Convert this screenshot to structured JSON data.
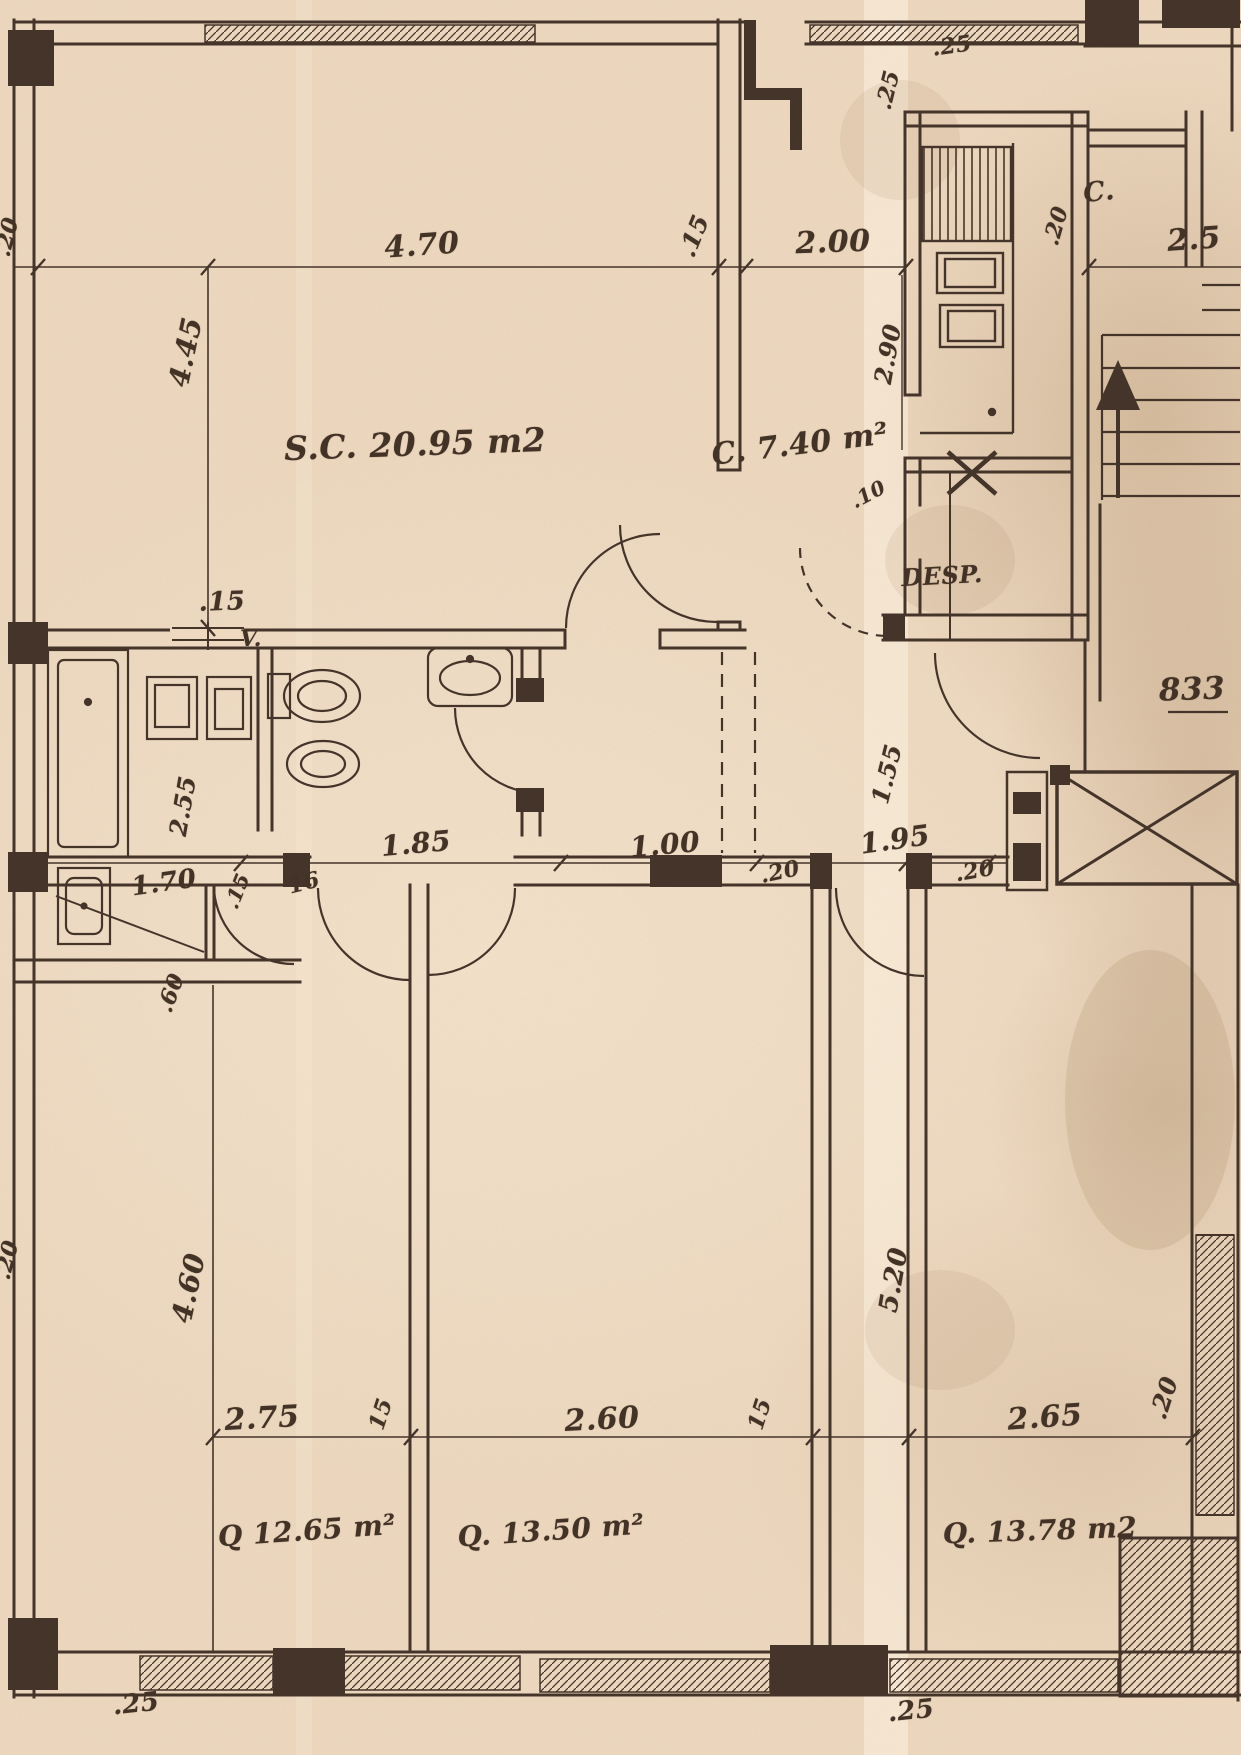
{
  "plan": {
    "kind": "architectural-floor-plan",
    "style": "aged-scanned-blueprint",
    "units": "meters",
    "colors": {
      "paper": "#eed9c0",
      "ink": "#45342a",
      "stain": "#8f6a42",
      "fold_highlight": "#fff6e6"
    },
    "rooms": [
      {
        "name": "living-dining-room",
        "code": "S.C.",
        "area_m2": 20.95
      },
      {
        "name": "kitchen",
        "code": "C.",
        "area_m2": 7.4
      },
      {
        "name": "pantry",
        "code": "DESP."
      },
      {
        "name": "stair-hall",
        "code": "C."
      },
      {
        "name": "bedroom-1",
        "code": "Q",
        "area_m2": 12.65
      },
      {
        "name": "bedroom-2",
        "code": "Q.",
        "area_m2": 13.5
      },
      {
        "name": "bedroom-3",
        "code": "Q.",
        "area_m2": 13.78
      }
    ],
    "sheet_number": "833",
    "labels": [
      {
        "name": "dim-width-living",
        "text": "4.70",
        "x": 422,
        "y": 246,
        "rot": -4,
        "fs": 30
      },
      {
        "name": "dim-height-living",
        "text": "4.45",
        "x": 186,
        "y": 352,
        "rot": -78,
        "fs": 28
      },
      {
        "name": "dim-wall-15-top",
        "text": ".15",
        "x": 694,
        "y": 236,
        "rot": -68,
        "fs": 24
      },
      {
        "name": "dim-width-hall",
        "text": "2.00",
        "x": 833,
        "y": 243,
        "rot": -2,
        "fs": 30
      },
      {
        "name": "dim-25-top",
        "text": ".25",
        "x": 952,
        "y": 46,
        "rot": -8,
        "fs": 22
      },
      {
        "name": "dim-25-top-wall",
        "text": ".25",
        "x": 888,
        "y": 90,
        "rot": -76,
        "fs": 22
      },
      {
        "name": "label-stairhall-c",
        "text": "C.",
        "x": 1099,
        "y": 192,
        "rot": -6,
        "fs": 27
      },
      {
        "name": "dim-20-kitchen-top",
        "text": ".20",
        "x": 1056,
        "y": 226,
        "rot": -74,
        "fs": 22
      },
      {
        "name": "dim-25-right",
        "text": "2.5",
        "x": 1194,
        "y": 240,
        "rot": -4,
        "fs": 30
      },
      {
        "name": "dim-height-kitchen",
        "text": "2.90",
        "x": 888,
        "y": 354,
        "rot": -80,
        "fs": 24
      },
      {
        "name": "room-living-label",
        "text": "S.C. 20.95 m2",
        "x": 415,
        "y": 444,
        "rot": -2,
        "fs": 33
      },
      {
        "name": "room-kitchen-label",
        "text": "C. 7.40 m²",
        "x": 800,
        "y": 445,
        "rot": -7,
        "fs": 30
      },
      {
        "name": "dim-door-10",
        "text": ".10",
        "x": 868,
        "y": 494,
        "rot": -28,
        "fs": 20
      },
      {
        "name": "room-pantry-label",
        "text": "DESP.",
        "x": 942,
        "y": 576,
        "rot": -3,
        "fs": 24
      },
      {
        "name": "dim-wall-15-bath",
        "text": ".15",
        "x": 222,
        "y": 602,
        "rot": -2,
        "fs": 26
      },
      {
        "name": "label-vent",
        "text": "V.",
        "x": 251,
        "y": 639,
        "rot": 0,
        "fs": 22
      },
      {
        "name": "sheet-number-label",
        "text": "833",
        "x": 1192,
        "y": 690,
        "rot": -2,
        "fs": 31
      },
      {
        "name": "dim-height-laundry",
        "text": "2.55",
        "x": 183,
        "y": 806,
        "rot": -80,
        "fs": 24
      },
      {
        "name": "dim-width-laundry",
        "text": "1.70",
        "x": 164,
        "y": 883,
        "rot": -8,
        "fs": 26
      },
      {
        "name": "dim-wall-15-mid",
        "text": ".15",
        "x": 237,
        "y": 891,
        "rot": -68,
        "fs": 20
      },
      {
        "name": "dim-wall-16",
        "text": "16",
        "x": 304,
        "y": 883,
        "rot": -14,
        "fs": 22
      },
      {
        "name": "dim-width-bath",
        "text": "1.85",
        "x": 416,
        "y": 844,
        "rot": -5,
        "fs": 28
      },
      {
        "name": "dim-width-corridor",
        "text": "1.00",
        "x": 665,
        "y": 845,
        "rot": -5,
        "fs": 28
      },
      {
        "name": "dim-wall-20-a",
        "text": ".20",
        "x": 780,
        "y": 872,
        "rot": -12,
        "fs": 22
      },
      {
        "name": "dim-height-155",
        "text": "1.55",
        "x": 887,
        "y": 774,
        "rot": -76,
        "fs": 24
      },
      {
        "name": "dim-width-195",
        "text": "1.95",
        "x": 895,
        "y": 840,
        "rot": -8,
        "fs": 28
      },
      {
        "name": "dim-wall-20-b",
        "text": ".20",
        "x": 975,
        "y": 871,
        "rot": -10,
        "fs": 22
      },
      {
        "name": "dim-closet-60",
        "text": ".60",
        "x": 171,
        "y": 993,
        "rot": -70,
        "fs": 22
      },
      {
        "name": "dim-20-left-top",
        "text": ".20",
        "x": 7,
        "y": 237,
        "rot": -76,
        "fs": 22
      },
      {
        "name": "dim-20-left-bottom",
        "text": ".20",
        "x": 7,
        "y": 1260,
        "rot": -76,
        "fs": 22
      },
      {
        "name": "dim-height-bed1",
        "text": "4.60",
        "x": 189,
        "y": 1288,
        "rot": -78,
        "fs": 28
      },
      {
        "name": "dim-height-bed3",
        "text": "5.20",
        "x": 894,
        "y": 1280,
        "rot": -80,
        "fs": 26
      },
      {
        "name": "dim-width-bed1",
        "text": "2.75",
        "x": 262,
        "y": 1419,
        "rot": -3,
        "fs": 30
      },
      {
        "name": "dim-wall-15-bed1",
        "text": "15",
        "x": 381,
        "y": 1414,
        "rot": -72,
        "fs": 22
      },
      {
        "name": "dim-width-bed2",
        "text": "2.60",
        "x": 602,
        "y": 1420,
        "rot": -3,
        "fs": 30
      },
      {
        "name": "dim-wall-15-bed2",
        "text": "15",
        "x": 760,
        "y": 1414,
        "rot": -72,
        "fs": 22
      },
      {
        "name": "dim-width-bed3",
        "text": "2.65",
        "x": 1045,
        "y": 1418,
        "rot": -4,
        "fs": 30
      },
      {
        "name": "dim-wall-20-bed3",
        "text": ".20",
        "x": 1164,
        "y": 1398,
        "rot": -72,
        "fs": 24
      },
      {
        "name": "room-bed1-label",
        "text": "Q 12.65 m²",
        "x": 307,
        "y": 1531,
        "rot": -4,
        "fs": 28
      },
      {
        "name": "room-bed2-label",
        "text": "Q. 13.50 m²",
        "x": 551,
        "y": 1531,
        "rot": -4,
        "fs": 28
      },
      {
        "name": "room-bed3-label",
        "text": "Q. 13.78 m2",
        "x": 1040,
        "y": 1531,
        "rot": -2,
        "fs": 28
      },
      {
        "name": "dim-25-bottom-left",
        "text": ".25",
        "x": 136,
        "y": 1704,
        "rot": -6,
        "fs": 26
      },
      {
        "name": "dim-25-bottom-right",
        "text": ".25",
        "x": 911,
        "y": 1711,
        "rot": -6,
        "fs": 26
      }
    ]
  }
}
